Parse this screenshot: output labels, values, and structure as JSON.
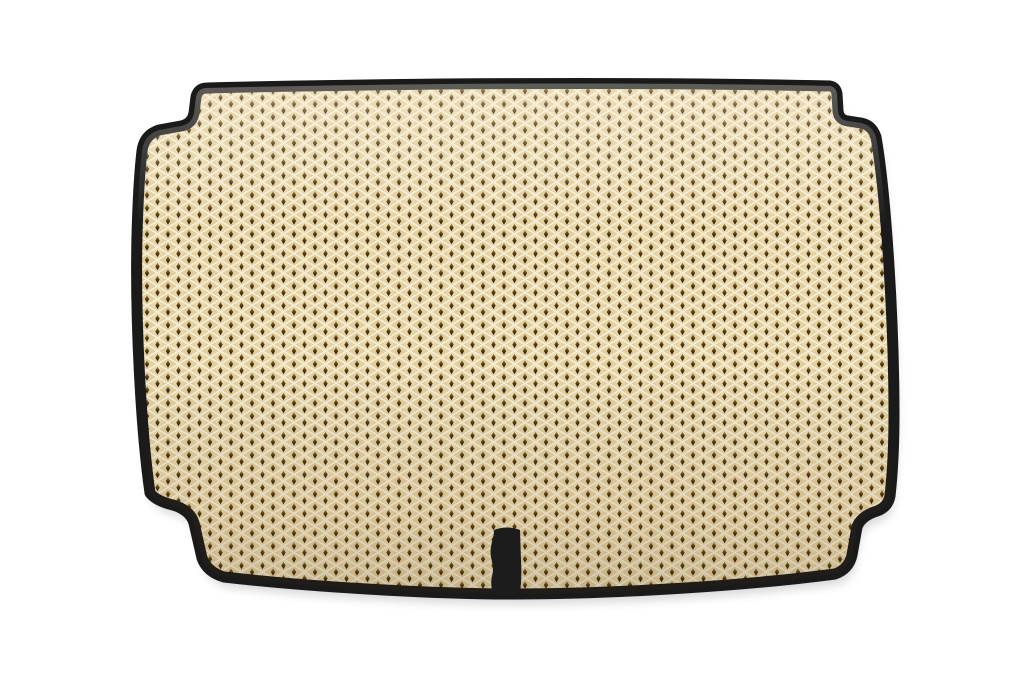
{
  "image": {
    "type": "product-photo",
    "subject": "EVA car trunk mat",
    "description": "Beige diamond-pattern EVA car trunk mat with black edge trim, stepped corner notches and a black fastening tab at the bottom center, on a white background",
    "background_color": "#ffffff",
    "colors": {
      "mat_base": "#e2cf9f",
      "cell_light": "#f0e2b8",
      "cell_mid": "#e4d1a1",
      "cell_dark": "#d7c088",
      "ridge": "#f6edd5",
      "hole_top": "#a08344",
      "hole_mid": "#5a3f16",
      "hole_bottom": "#1a1003",
      "edge_trim": "#1a1a1a",
      "tab": "#1c1c1c",
      "shadow": "#000000"
    },
    "features": {
      "pattern": "rhombus / diamond EVA cells",
      "trim": "black textile edge binding",
      "tab": "black fastening strap at bottom center",
      "corners": "stepped notches at all four corners"
    }
  }
}
